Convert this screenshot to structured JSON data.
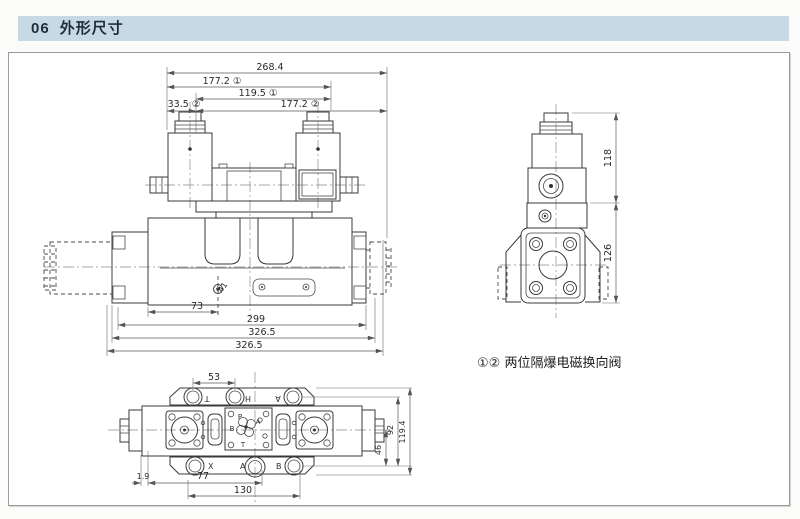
{
  "header": {
    "number": "06",
    "title": "外形尺寸"
  },
  "front_view": {
    "dim_overall": "268.4",
    "dim_1772_1": "177.2 ①",
    "dim_1195_1": "119.5 ①",
    "dim_335_2": "33.5 ②",
    "dim_1772_2": "177.2 ②",
    "dim_73": "73",
    "dim_299": "299",
    "dim_3265_inner": "326.5",
    "dim_3265_outer": "326.5",
    "label_41": "41"
  },
  "side_view": {
    "dim_118": "118",
    "dim_126": "126"
  },
  "top_view": {
    "dim_53": "53",
    "dim_46": "46",
    "dim_92": "92",
    "dim_1194": "119.4",
    "dim_19": "1.9",
    "dim_77": "77",
    "dim_130": "130",
    "ports_top": [
      "T",
      "H",
      "A"
    ],
    "ports_bottom": [
      "X",
      "A",
      "B"
    ],
    "pilot_ports": {
      "p": "P",
      "a": "A",
      "b": "B",
      "t": "T"
    }
  },
  "note": {
    "text": "①② 两位隔爆电磁换向阀"
  }
}
